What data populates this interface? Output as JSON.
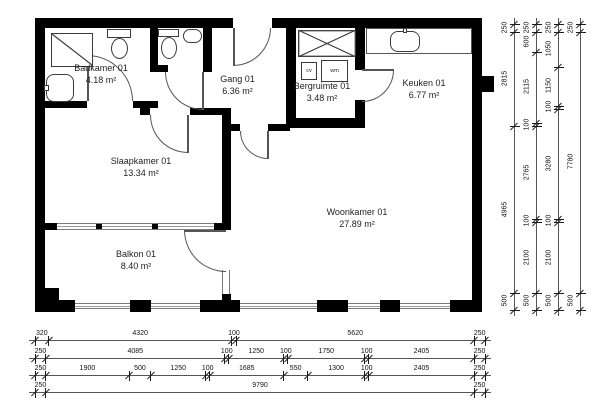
{
  "rooms": [
    {
      "name": "Badkamer 01",
      "area": "4.18 m²"
    },
    {
      "name": "Gang 01",
      "area": "6.36 m²"
    },
    {
      "name": "Bergruimte 01",
      "area": "3.48 m²"
    },
    {
      "name": "Keuken 01",
      "area": "6.77 m²"
    },
    {
      "name": "Slaapkamer 01",
      "area": "13.34 m²"
    },
    {
      "name": "Woonkamer 01",
      "area": "27.89 m²"
    },
    {
      "name": "Balkon 01",
      "area": "8.40 m²"
    }
  ],
  "appliances": {
    "cv": "cv",
    "wm": "wm"
  },
  "dimensions": {
    "right_columns": [
      {
        "values": [
          "250",
          "2815",
          "4965",
          "500"
        ]
      },
      {
        "values": [
          "250",
          "600",
          "2115",
          "100",
          "2765",
          "100",
          "2100",
          "500"
        ]
      },
      {
        "values": [
          "250",
          "1050",
          "1150",
          "100",
          "3280",
          "100",
          "2100",
          "500"
        ]
      },
      {
        "values": [
          "250",
          "7780",
          "500"
        ]
      }
    ],
    "bottom_rows": [
      {
        "values": [
          "320",
          "4320",
          "100",
          "5620",
          "250"
        ]
      },
      {
        "values": [
          "250",
          "4085",
          "100",
          "1250",
          "100",
          "1750",
          "100",
          "2405",
          "250"
        ]
      },
      {
        "values": [
          "250",
          "1900",
          "500",
          "1250",
          "100",
          "1685",
          "550",
          "1300",
          "100",
          "2405",
          "250"
        ]
      },
      {
        "values": [
          "250",
          "9790",
          "250"
        ]
      }
    ]
  },
  "colors": {
    "wall": "#000000",
    "window": "#7a7a7a",
    "line": "#555555",
    "text": "#1f1f1f"
  }
}
